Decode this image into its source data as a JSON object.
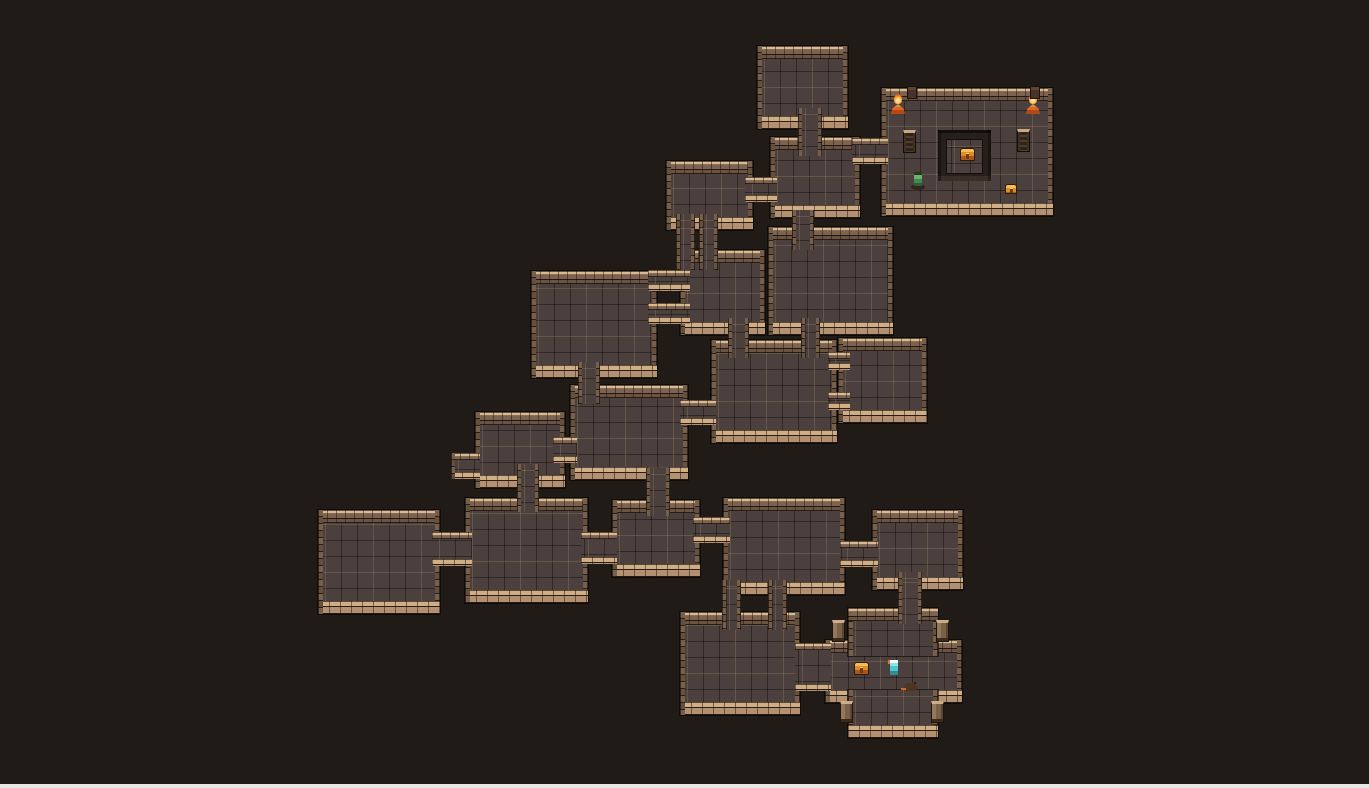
{
  "scene": {
    "width": 1369,
    "height": 788,
    "tile_size": 16
  },
  "palette": {
    "bg": "#211b18",
    "floor": "#4b403d",
    "wallCap": "#d9b98f",
    "wallMid": "#7c6250",
    "wallDark": "#6b5342",
    "pit": "#271f1b",
    "flame": "#e1571d",
    "chest": "#e08a28",
    "goblin": "#3f8a4b",
    "hero": "#4fc7cf",
    "rat": "#4f3420",
    "edge": "#e9e7e4"
  },
  "rooms": [
    {
      "id": "top",
      "x": 757,
      "y": 46,
      "w": 91,
      "h": 83
    },
    {
      "id": "treasure",
      "x": 881,
      "y": 88,
      "w": 172,
      "h": 128
    },
    {
      "id": "mid-a",
      "x": 770,
      "y": 137,
      "w": 90,
      "h": 81
    },
    {
      "id": "mid-b",
      "x": 666,
      "y": 161,
      "w": 87,
      "h": 69
    },
    {
      "id": "west-a",
      "x": 680,
      "y": 250,
      "w": 85,
      "h": 85
    },
    {
      "id": "central-hall",
      "x": 768,
      "y": 227,
      "w": 125,
      "h": 108
    },
    {
      "id": "big-west",
      "x": 531,
      "y": 271,
      "w": 126,
      "h": 107
    },
    {
      "id": "central-a",
      "x": 711,
      "y": 340,
      "w": 126,
      "h": 103
    },
    {
      "id": "central-b",
      "x": 838,
      "y": 338,
      "w": 89,
      "h": 85
    },
    {
      "id": "mid-west-a",
      "x": 475,
      "y": 412,
      "w": 90,
      "h": 76
    },
    {
      "id": "mid-west-b",
      "x": 570,
      "y": 385,
      "w": 118,
      "h": 95
    },
    {
      "id": "south-west",
      "x": 318,
      "y": 510,
      "w": 122,
      "h": 104
    },
    {
      "id": "south-a",
      "x": 465,
      "y": 498,
      "w": 123,
      "h": 105
    },
    {
      "id": "south-b",
      "x": 612,
      "y": 500,
      "w": 88,
      "h": 77
    },
    {
      "id": "south-c",
      "x": 723,
      "y": 498,
      "w": 122,
      "h": 97
    },
    {
      "id": "south-d",
      "x": 872,
      "y": 510,
      "w": 91,
      "h": 80
    },
    {
      "id": "south-e",
      "x": 680,
      "y": 612,
      "w": 120,
      "h": 103
    },
    {
      "id": "vault-mid",
      "x": 825,
      "y": 640,
      "w": 137,
      "h": 63
    },
    {
      "id": "vault-top",
      "x": 848,
      "y": 608,
      "w": 90,
      "h": 48,
      "sides": "lrt"
    },
    {
      "id": "vault-bot",
      "x": 848,
      "y": 690,
      "w": 90,
      "h": 48,
      "sides": "lrb"
    }
  ],
  "corridors": [
    {
      "id": "top-down",
      "x": 798,
      "y": 108,
      "w": 24,
      "h": 48,
      "sides": "lr"
    },
    {
      "id": "midb-mida",
      "x": 745,
      "y": 177,
      "w": 32,
      "h": 25,
      "sides": "tb"
    },
    {
      "id": "mida-treasure",
      "x": 852,
      "y": 138,
      "w": 36,
      "h": 26,
      "sides": "tb"
    },
    {
      "id": "mida-hall",
      "x": 792,
      "y": 210,
      "w": 22,
      "h": 40,
      "sides": "lr"
    },
    {
      "id": "midb-westa-1",
      "x": 676,
      "y": 214,
      "w": 19,
      "h": 56,
      "sides": "lr"
    },
    {
      "id": "midb-westa-2",
      "x": 699,
      "y": 214,
      "w": 19,
      "h": 56,
      "sides": "lr"
    },
    {
      "id": "bigwest-westa-1",
      "x": 648,
      "y": 270,
      "w": 42,
      "h": 21,
      "sides": "tb"
    },
    {
      "id": "bigwest-westa-2",
      "x": 648,
      "y": 303,
      "w": 42,
      "h": 21,
      "sides": "tb"
    },
    {
      "id": "westa-centrala",
      "x": 728,
      "y": 318,
      "w": 21,
      "h": 40,
      "sides": "lr"
    },
    {
      "id": "hall-centrala",
      "x": 801,
      "y": 318,
      "w": 19,
      "h": 40,
      "sides": "lr"
    },
    {
      "id": "centrala-b-1",
      "x": 828,
      "y": 352,
      "w": 22,
      "h": 18,
      "sides": "tb"
    },
    {
      "id": "centrala-b-2",
      "x": 828,
      "y": 392,
      "w": 22,
      "h": 18,
      "sides": "tb"
    },
    {
      "id": "midwestb-centrala",
      "x": 680,
      "y": 400,
      "w": 36,
      "h": 25,
      "sides": "tb"
    },
    {
      "id": "bigwest-down",
      "x": 578,
      "y": 362,
      "w": 22,
      "h": 42,
      "sides": "lr"
    },
    {
      "id": "midwest-ab",
      "x": 553,
      "y": 437,
      "w": 24,
      "h": 26,
      "sides": "tb"
    },
    {
      "id": "midwesta-stub",
      "x": 451,
      "y": 453,
      "w": 29,
      "h": 26,
      "sides": "tbl"
    },
    {
      "id": "midwesta-down",
      "x": 517,
      "y": 464,
      "w": 22,
      "h": 48,
      "sides": "lr"
    },
    {
      "id": "southwest-southa",
      "x": 432,
      "y": 532,
      "w": 40,
      "h": 34,
      "sides": "tb"
    },
    {
      "id": "southa-southb",
      "x": 581,
      "y": 532,
      "w": 36,
      "h": 32,
      "sides": "tb"
    },
    {
      "id": "midwestb-southb",
      "x": 646,
      "y": 468,
      "w": 24,
      "h": 48,
      "sides": "lr"
    },
    {
      "id": "southb-southc",
      "x": 693,
      "y": 517,
      "w": 37,
      "h": 26,
      "sides": "tb"
    },
    {
      "id": "southc-southd",
      "x": 840,
      "y": 541,
      "w": 38,
      "h": 26,
      "sides": "tb"
    },
    {
      "id": "southc-southe-1",
      "x": 722,
      "y": 580,
      "w": 19,
      "h": 50,
      "sides": "lr"
    },
    {
      "id": "southc-southe-2",
      "x": 768,
      "y": 580,
      "w": 19,
      "h": 50,
      "sides": "lr"
    },
    {
      "id": "southd-vault",
      "x": 898,
      "y": 572,
      "w": 24,
      "h": 52,
      "sides": "lr"
    },
    {
      "id": "southe-vault",
      "x": 795,
      "y": 643,
      "w": 36,
      "h": 48,
      "sides": "tb"
    }
  ],
  "features": {
    "pit": {
      "x": 938,
      "y": 130,
      "w": 53,
      "h": 51
    },
    "island": {
      "x": 947,
      "y": 140,
      "w": 35,
      "h": 33
    },
    "bottom_edge": {
      "h": 4
    }
  },
  "sprites": [
    {
      "type": "torch",
      "x": 891,
      "y": 94
    },
    {
      "type": "torch",
      "x": 1026,
      "y": 94
    },
    {
      "type": "post",
      "x": 907,
      "y": 86
    },
    {
      "type": "post",
      "x": 1030,
      "y": 86
    },
    {
      "type": "ladder",
      "x": 903,
      "y": 130
    },
    {
      "type": "ladder",
      "x": 1017,
      "y": 129
    },
    {
      "type": "chest",
      "x": 960,
      "y": 148
    },
    {
      "type": "goblin",
      "x": 911,
      "y": 172
    },
    {
      "type": "chest-small",
      "x": 1005,
      "y": 184
    },
    {
      "type": "pillar",
      "x": 832,
      "y": 620
    },
    {
      "type": "pillar",
      "x": 936,
      "y": 620
    },
    {
      "type": "pillar",
      "x": 840,
      "y": 701
    },
    {
      "type": "pillar",
      "x": 931,
      "y": 701
    },
    {
      "type": "chest",
      "x": 854,
      "y": 662
    },
    {
      "type": "hero",
      "x": 888,
      "y": 660
    },
    {
      "type": "rat",
      "x": 904,
      "y": 683
    }
  ]
}
